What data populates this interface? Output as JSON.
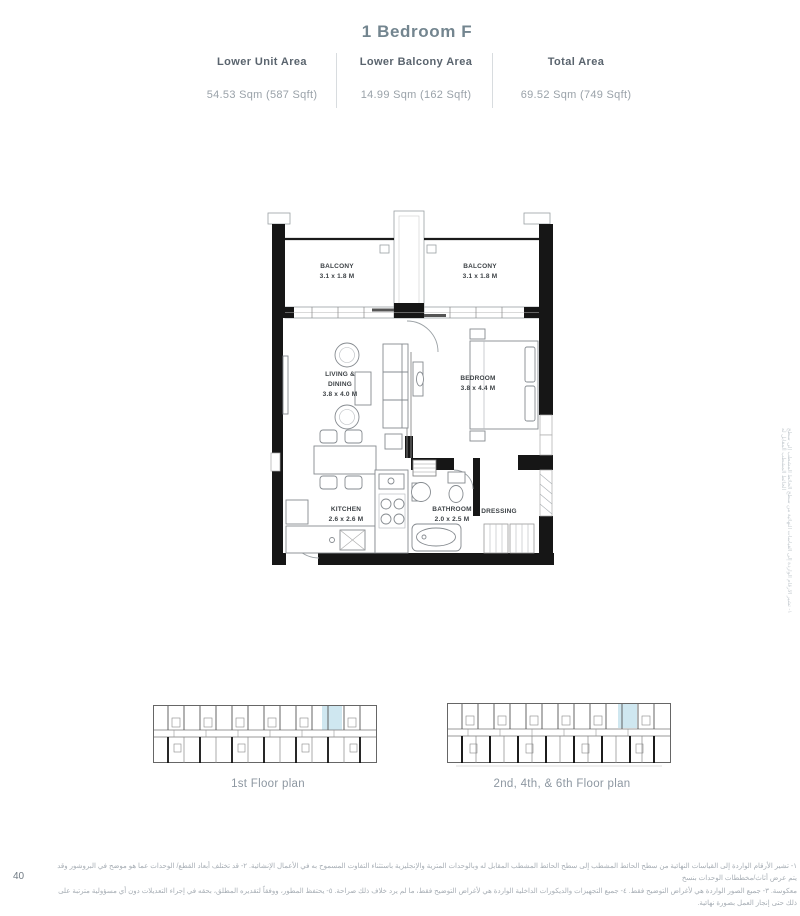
{
  "page": {
    "number": "40",
    "title": "1 Bedroom F"
  },
  "stats": {
    "columns": [
      {
        "label": "Lower Unit Area",
        "value": "54.53 Sqm (587 Sqft)"
      },
      {
        "label": "Lower Balcony Area",
        "value": "14.99 Sqm (162 Sqft)"
      },
      {
        "label": "Total Area",
        "value": "69.52 Sqm (749 Sqft)"
      }
    ]
  },
  "floorplan": {
    "rooms": [
      {
        "name": "BALCONY",
        "dims": "3.1 x 1.8 M"
      },
      {
        "name": "BALCONY",
        "dims": "3.1 x 1.8 M"
      },
      {
        "name": "LIVING &\nDINING",
        "dims": "3.8 x 4.0 M"
      },
      {
        "name": "BEDROOM",
        "dims": "3.8 x 4.4 M"
      },
      {
        "name": "KITCHEN",
        "dims": "2.6 x 2.6 M"
      },
      {
        "name": "BATHROOM",
        "dims": "2.0 x 2.5 M"
      },
      {
        "name": "DRESSING",
        "dims": ""
      }
    ]
  },
  "mini_plans": [
    {
      "caption": "1st Floor plan"
    },
    {
      "caption": "2nd, 4th, & 6th Floor plan"
    }
  ],
  "footnote": {
    "line1": "١- تشير الأرقام الواردة إلى القياسات النهائية من سطح الحائط المشطب إلى سطح الحائط المشطب المقابل له وبالوحدات المترية والإنجليزية باستثناء التفاوت المسموح به في الأعمال الإنشائية. ٢- قد تختلف أبعاد القطع/ الوحدات عما هو موضح في البروشور وقد يتم عرض أثاث/مخططات الوحدات بنسخ",
    "line2": "معكوسة. ٣- جميع الصور الواردة هي لأغراض التوضيح فقط. ٤- جميع التجهيزات والديكورات الداخلية الواردة هي لأغراض التوضيح فقط، ما لم يرد خلاف ذلك صراحة. ٥- يحتفظ المطور، ووفقاً لتقديره المطلق، بحقه في إجراء التعديلات دون أي مسؤولية مترتبة على ذلك حتى إنجاز العمل بصورة نهائية."
  },
  "side_note": "١- تشير الأرقام الواردة إلى القياسات النهائية من سطح الحائط المشطب إلى سطح الحائط المشطب المقابل له",
  "colors": {
    "title_text": "#73858f",
    "label_text": "#5a646e",
    "value_text": "#9aa2a9",
    "wall": "#161616",
    "highlight_unit": "#cfe7f0"
  }
}
